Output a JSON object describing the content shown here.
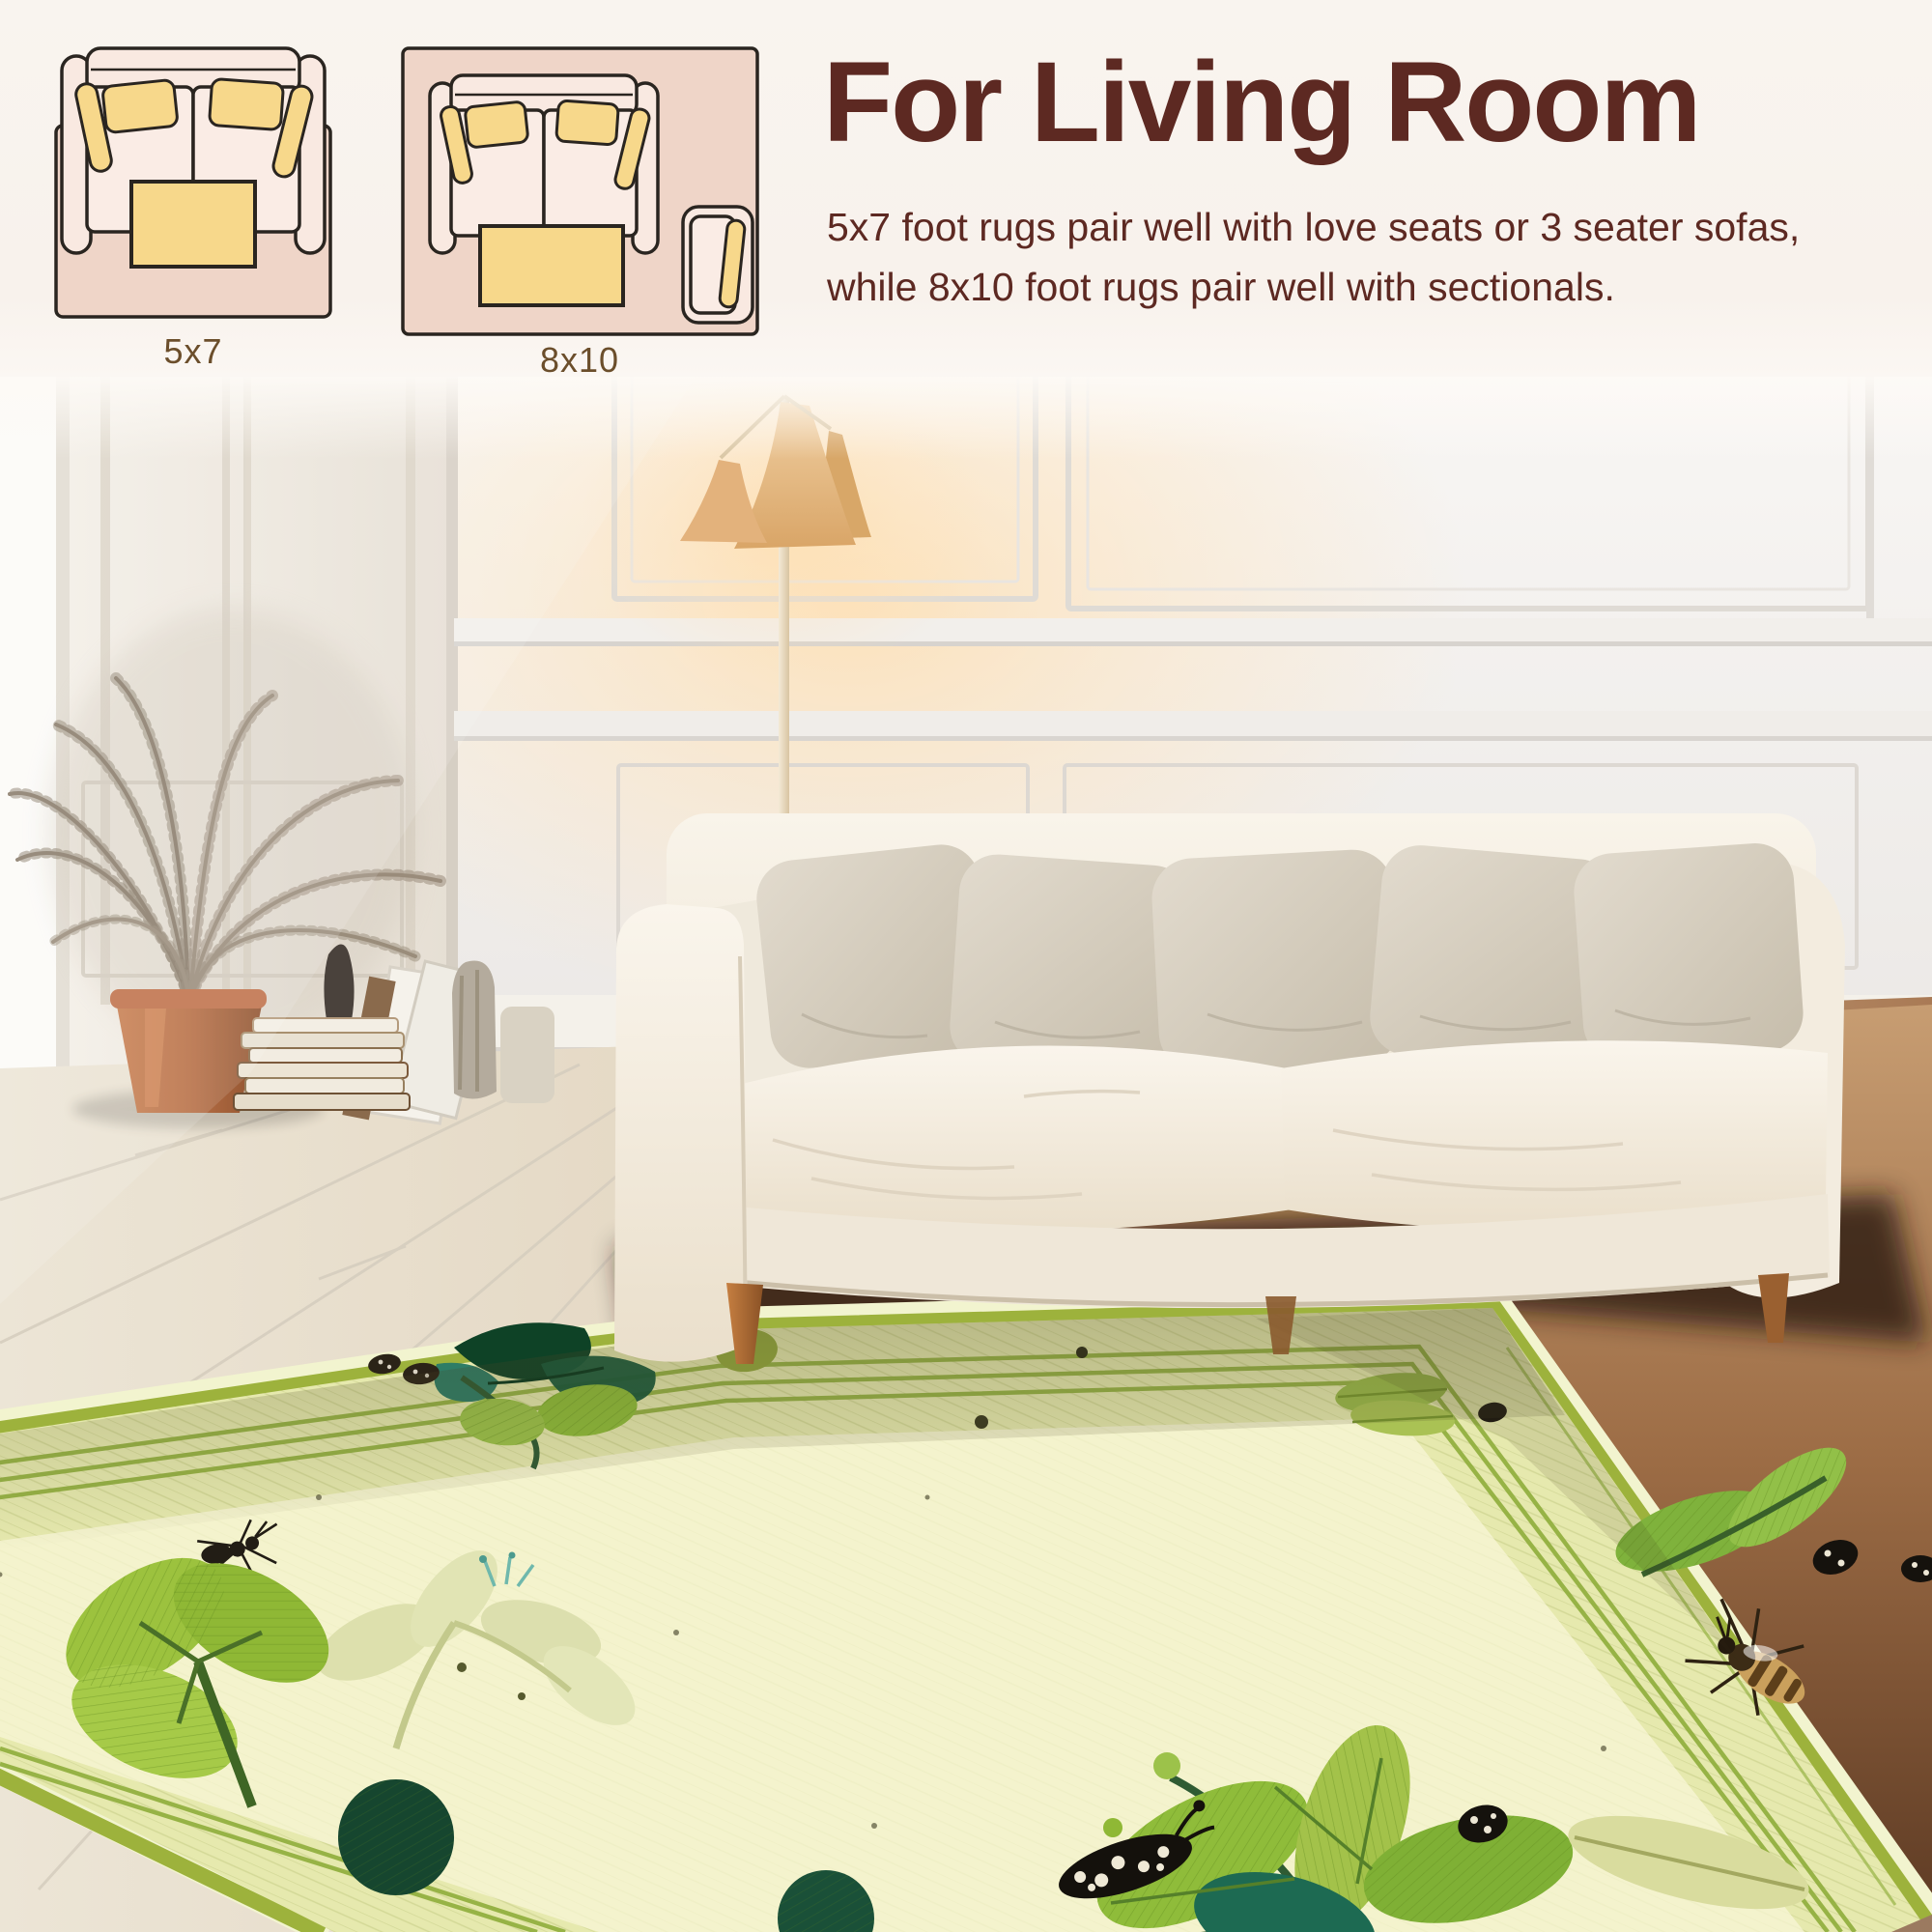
{
  "header": {
    "title": "For Living Room",
    "description": "5x7 foot rugs pair well with love seats or 3 seater sofas, while 8x10 foot rugs pair well with sectionals.",
    "diagrams": [
      {
        "label": "5x7"
      },
      {
        "label": "8x10"
      }
    ]
  },
  "colors": {
    "page_background": "#f8f3ee",
    "title_text": "#5d2922",
    "body_text": "#5d2922",
    "diagram_label_text": "#6b4e2b",
    "diagram_rug_pink": "#efd5c8",
    "diagram_sofa_fill": "#f9e9e1",
    "diagram_yellow": "#f7d88b",
    "diagram_outline": "#2a2520",
    "rug_field_cream": "#f4f3cd",
    "rug_border_green": "#e6e9ae",
    "rug_stripe_green": "#8fae3b",
    "rug_dark_leaf_green": "#14532f",
    "rug_leaf_green": "#8fbc3a",
    "sofa_cream": "#f3ecdf",
    "pillow_greige": "#d7d0c2",
    "lamp_shade_tan": "#e6bd8d",
    "pot_terracotta": "#b86f45",
    "floor_light_wood": "#e9e2d4",
    "floor_warm_wood": "#a97a55"
  }
}
